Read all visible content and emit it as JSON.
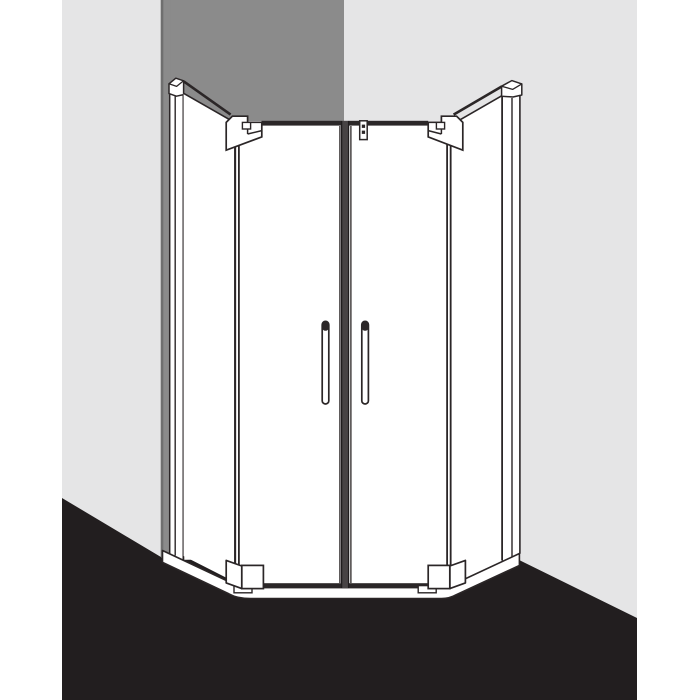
{
  "diagram": {
    "type": "product-line-drawing",
    "subject": "pentagon corner shower enclosure with two hinged swing doors and side panels",
    "view": "front view of enclosure standing in a room corner",
    "text_content": "none"
  },
  "colors": {
    "page_background": "#ffffff",
    "wall_light_gray": "#e5e5e6",
    "wall_dark_gray": "#8b8b8b",
    "wall_corner_edge": "#6f6f6f",
    "floor_black": "#221e1f",
    "outline": "#2b2627",
    "frame_profile_dark": "#2b2728",
    "mullion_gray": "#474344",
    "glass_white": "#ffffff"
  },
  "parts": {
    "left_wall": "left wall",
    "corner_wall": "shaded corner wall",
    "right_wall": "right wall",
    "floor": "floor",
    "left_side_panel": "left fixed side panel",
    "left_panel_cap": "left wall profile cap",
    "left_angled_panel": "left angled fixed segment",
    "left_top_hinge": "left door top hinge",
    "left_door": "left swing door",
    "left_handle": "left door handle",
    "center_mullion": "center door junction profile",
    "glass_clamp": "glass stabilizer clamp",
    "right_door": "right swing door",
    "right_handle": "right door handle",
    "right_top_hinge": "right door top hinge",
    "right_angled_panel": "right angled fixed segment",
    "right_side_panel": "right fixed side panel",
    "right_panel_cap": "right wall profile cap",
    "left_bottom_hinge": "left door bottom hinge",
    "right_bottom_hinge": "right door bottom hinge",
    "base": "shower base sill"
  }
}
